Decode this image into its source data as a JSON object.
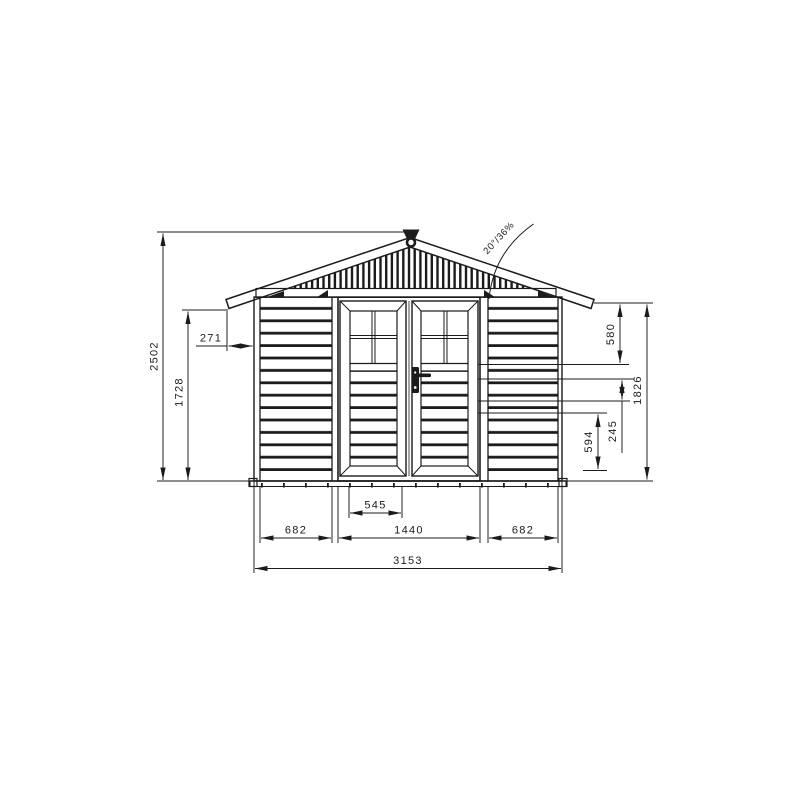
{
  "drawing": {
    "background": "#ffffff",
    "line_color": "#1b1b1b",
    "annotations": {
      "roof_pitch": "20°/36%"
    },
    "dims": {
      "overall_height": "2502",
      "eave_height": "1728",
      "roof_overhang": "271",
      "top_to_window_sill": "580",
      "wall_height": "1826",
      "lower_panel": "594",
      "mid_panel": "245",
      "door_leaf_width": "545",
      "left_bay": "682",
      "door_bay": "1440",
      "right_bay": "682",
      "overall_width": "3153"
    }
  }
}
